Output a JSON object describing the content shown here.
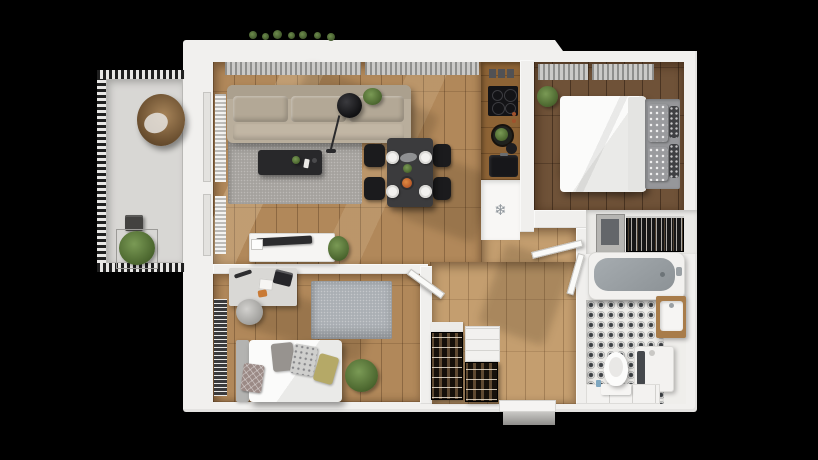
{
  "meta": {
    "type": "3d-floorplan-render",
    "view": "top-down 3D render of a one-bedroom apartment with balcony on a black background",
    "width_px": 818,
    "height_px": 460
  },
  "palette": {
    "background": "#000000",
    "wall": "#f0efed",
    "wood_living": "#b1885a",
    "wood_hall": "#c49e6f",
    "wood_bedroom": "#6f5238",
    "balcony_floor": "#d8d7d4",
    "rug_living": "#a5a29e",
    "rug_office": "#aaafb4",
    "sofa": "#b9ae9c",
    "furniture_dark": "#28282a",
    "tub_basin": "#9aa0a5",
    "tile_pattern": "#3e4246",
    "plant_green": "#4c672f",
    "food_accent": "#cf7030",
    "rattan_chair": "#8a6a42"
  },
  "kitchen": {
    "fridge_icon": "❄"
  },
  "rooms": [
    {
      "name": "balcony",
      "furniture": [
        "hanging egg chair",
        "planter shrub",
        "storage box",
        "slatted railing"
      ]
    },
    {
      "name": "living-dining",
      "furniture": [
        "three-seat sofa",
        "area rug",
        "coffee table",
        "arc floor lamp",
        "potted plant",
        "dining table",
        "four chairs",
        "four place settings",
        "sideboard with tv",
        "wall radiators",
        "window blinds"
      ]
    },
    {
      "name": "kitchen",
      "furniture": [
        "wood counter",
        "upper storage boxes",
        "four-burner cooktop",
        "cutting board with greens",
        "sink",
        "refrigerator"
      ]
    },
    {
      "name": "bedroom",
      "furniture": [
        "double bed",
        "patterned pillows",
        "window curtains",
        "potted plant",
        "wardrobe cabinet",
        "open closet with hanging clothes"
      ]
    },
    {
      "name": "bathroom",
      "furniture": [
        "bathtub",
        "patterned tile floor",
        "wood vanity with basin",
        "washing machine",
        "toilet",
        "storage drawers"
      ]
    },
    {
      "name": "office-bedroom",
      "furniture": [
        "desk with laptop",
        "desk chair",
        "area rug",
        "single bed",
        "cushions",
        "potted plant",
        "radiator"
      ]
    },
    {
      "name": "hallway",
      "furniture": [
        "shoe rack",
        "white storage cabinet",
        "entrance door",
        "entrance step",
        "open interior doors"
      ]
    }
  ]
}
